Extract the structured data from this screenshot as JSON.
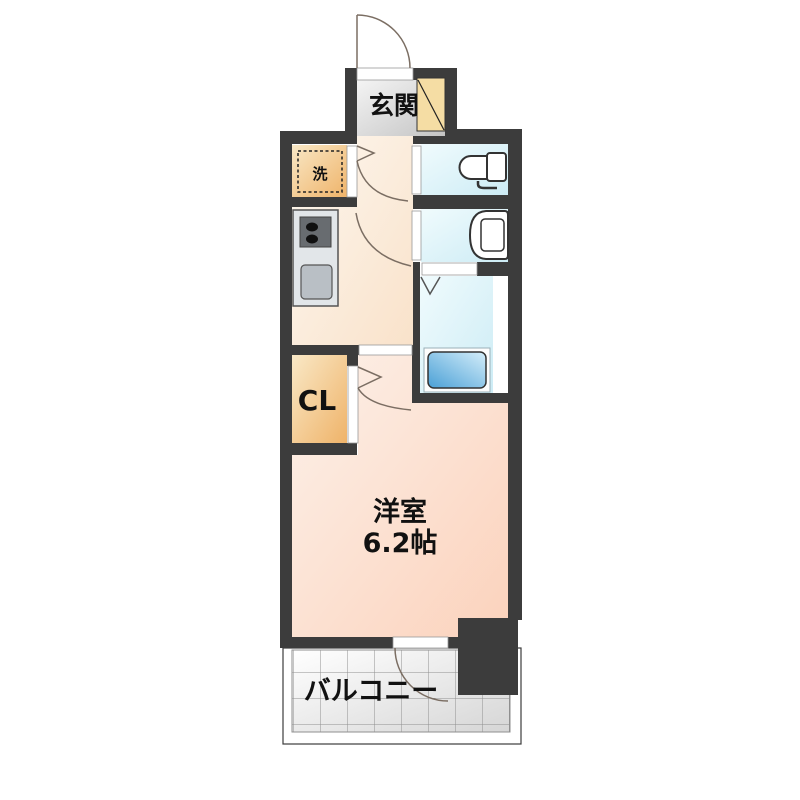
{
  "floorplan": {
    "entrance": {
      "label": "玄関"
    },
    "washer": {
      "label": "洗"
    },
    "closet": {
      "label": "CL"
    },
    "western_room": {
      "label": "洋室",
      "size": "6.2帖"
    },
    "balcony": {
      "label": "バルコニー"
    }
  },
  "colors": {
    "wall": "#3c3c3c",
    "entrance_floor_gray": "#c9c9c9",
    "hall_kitchen_cream": "#f9e2ca",
    "main_room_peach": "#fbd2bc",
    "wet_area_blue": "#cdecf5",
    "storage_orange": "#efb369",
    "shoe_cabinet_beige": "#f5dda4",
    "bathtub_blue": "#4aa0d6",
    "balcony_gray": "#d6d6d6"
  },
  "icons": [
    "toilet-icon",
    "washbasin-icon",
    "bathtub-icon",
    "stove-icon",
    "kitchen-sink-icon",
    "washing-machine-space-icon",
    "door-swing-icon"
  ]
}
